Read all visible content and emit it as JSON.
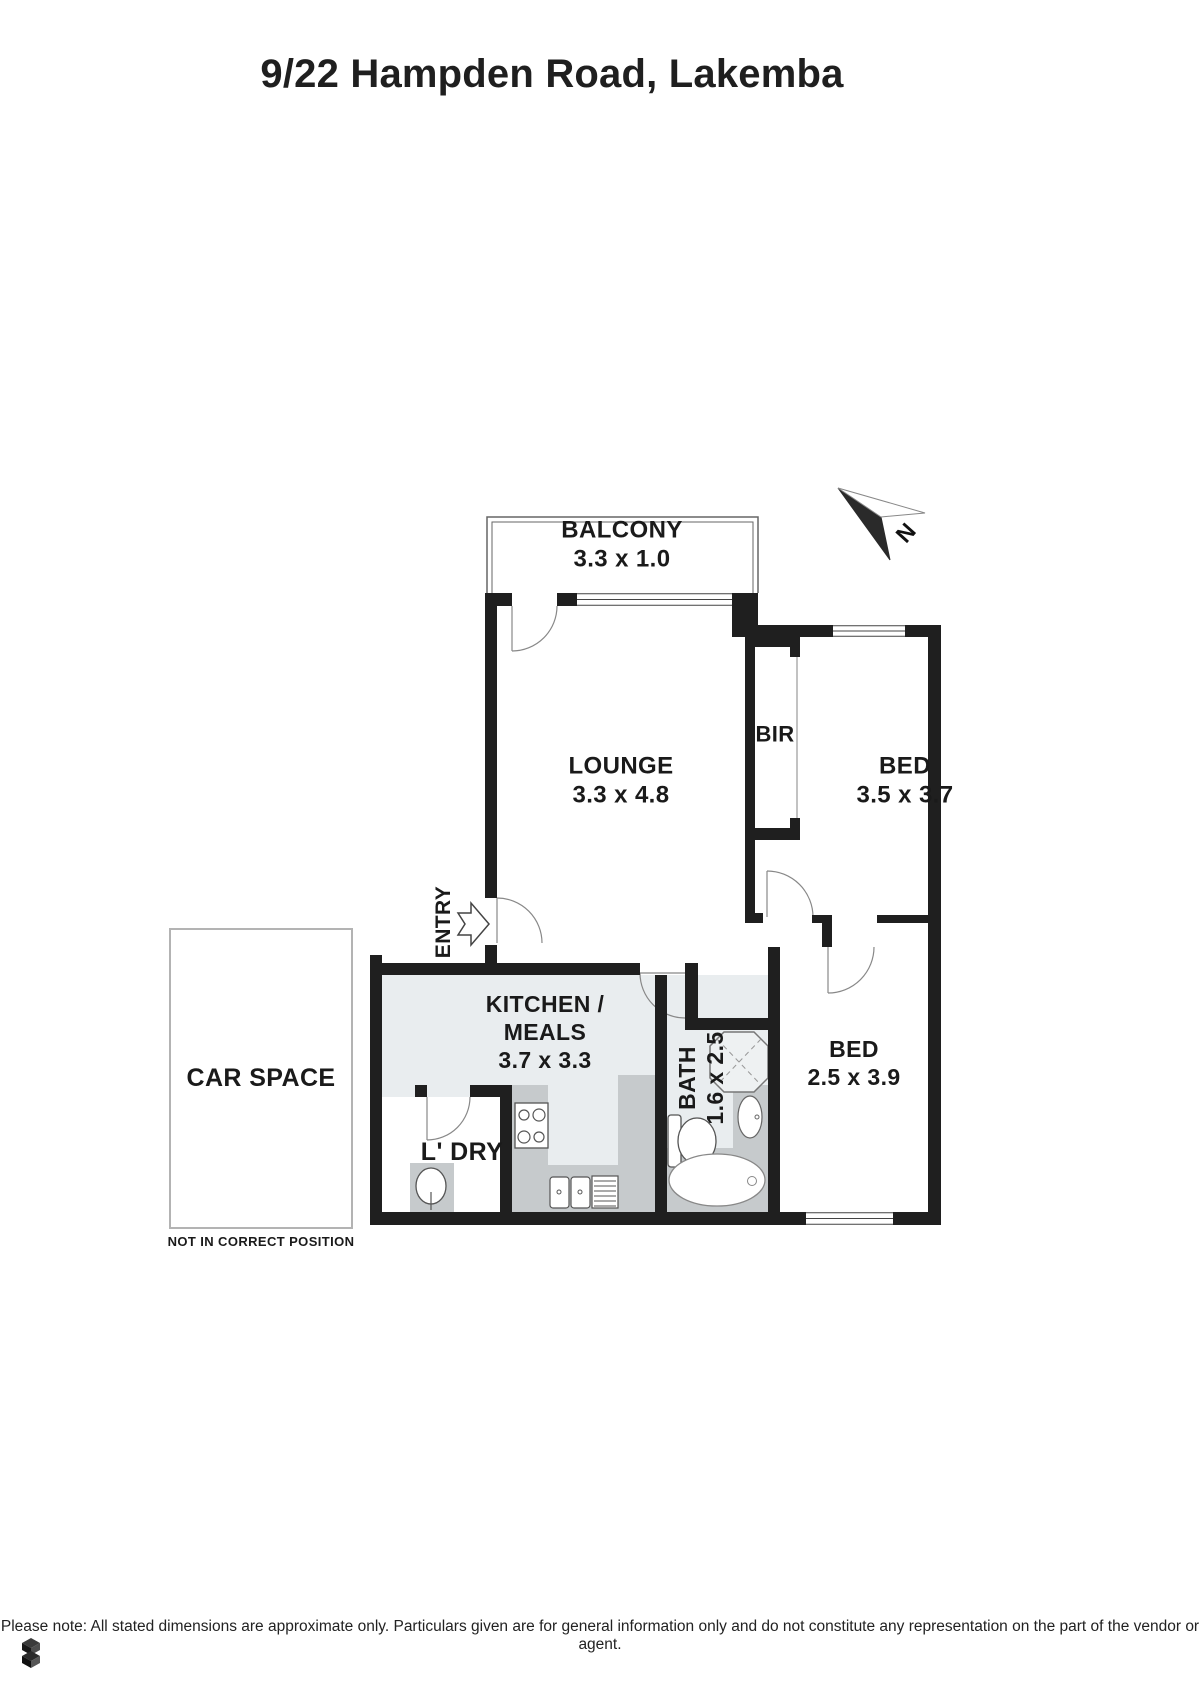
{
  "page": {
    "title": "9/22 Hampden Road, Lakemba",
    "footer": "Please note: All stated dimensions are approximate only. Particulars given are for general information only and do not constitute any representation on the part of the vendor or agent."
  },
  "compass": {
    "letter": "N",
    "x": 906,
    "y": 533,
    "fs": 23
  },
  "labels": [
    {
      "name": "balcony-label",
      "x": 622,
      "y": 545,
      "fs": 24,
      "lines": [
        "BALCONY",
        "3.3 x 1.0"
      ]
    },
    {
      "name": "lounge-label",
      "x": 621,
      "y": 781,
      "fs": 24,
      "lines": [
        "LOUNGE",
        "3.3 x 4.8"
      ]
    },
    {
      "name": "bed1-label",
      "x": 905,
      "y": 781,
      "fs": 24,
      "lines": [
        "BED",
        "3.5 x 3.7"
      ]
    },
    {
      "name": "bir-label",
      "x": 775,
      "y": 735,
      "fs": 22,
      "lines": [
        "BIR"
      ]
    },
    {
      "name": "kitchen-label",
      "x": 545,
      "y": 1032,
      "fs": 23,
      "lines": [
        "KITCHEN /",
        "MEALS",
        "3.7 x 3.3"
      ]
    },
    {
      "name": "bath-label",
      "x": 701,
      "y": 1078,
      "fs": 23,
      "rot": true,
      "lines": [
        "BATH",
        "1.6 x 2.5"
      ]
    },
    {
      "name": "bed2-label",
      "x": 854,
      "y": 1063,
      "fs": 23,
      "lines": [
        "BED",
        "2.5 x 3.9"
      ]
    },
    {
      "name": "entry-label",
      "x": 444,
      "y": 922,
      "fs": 21,
      "rot": true,
      "lines": [
        "ENTRY"
      ]
    },
    {
      "name": "laundry-label",
      "x": 462,
      "y": 1152,
      "fs": 25,
      "lines": [
        "L' DRY"
      ]
    },
    {
      "name": "carspace-label",
      "x": 261,
      "y": 1078,
      "fs": 25,
      "lines": [
        "CAR SPACE"
      ]
    },
    {
      "name": "carspace-note",
      "x": 261,
      "y": 1242,
      "fs": 13,
      "lines": [
        "NOT IN CORRECT POSITION"
      ]
    }
  ],
  "plan": {
    "colors": {
      "wall": "#1f1f1f",
      "tint": "#e9edef",
      "counter": "#c6cacc",
      "thin": "#888",
      "fix": "#555"
    },
    "walls": [
      [
        485,
        593,
        27,
        13
      ],
      [
        557,
        593,
        20,
        13
      ],
      [
        732,
        593,
        26,
        44
      ],
      [
        758,
        625,
        75,
        12
      ],
      [
        905,
        625,
        36,
        12
      ],
      [
        928,
        625,
        13,
        600
      ],
      [
        485,
        593,
        12,
        305
      ],
      [
        485,
        945,
        12,
        30
      ],
      [
        745,
        606,
        10,
        307
      ],
      [
        745,
        913,
        18,
        10
      ],
      [
        812,
        915,
        10,
        8
      ],
      [
        822,
        915,
        10,
        32
      ],
      [
        877,
        915,
        64,
        8
      ],
      [
        370,
        955,
        12,
        270
      ],
      [
        382,
        963,
        258,
        12
      ],
      [
        685,
        963,
        13,
        67
      ],
      [
        692,
        1018,
        88,
        12
      ],
      [
        655,
        975,
        12,
        237
      ],
      [
        768,
        947,
        12,
        265
      ],
      [
        370,
        1212,
        436,
        13
      ],
      [
        893,
        1212,
        48,
        13
      ],
      [
        415,
        1085,
        12,
        12
      ],
      [
        470,
        1085,
        42,
        12
      ],
      [
        500,
        1085,
        12,
        127
      ],
      [
        755,
        635,
        45,
        12
      ],
      [
        790,
        647,
        10,
        10
      ],
      [
        755,
        828,
        45,
        12
      ],
      [
        790,
        818,
        10,
        10
      ]
    ],
    "windows": [
      {
        "x": 577,
        "y": 593,
        "w": 155,
        "h": 13
      },
      {
        "x": 833,
        "y": 625,
        "w": 72,
        "h": 12
      },
      {
        "x": 806,
        "y": 1212,
        "w": 87,
        "h": 13
      }
    ],
    "shapes": [
      {
        "t": "rect",
        "n": "kitchen-floor",
        "x": 382,
        "y": 975,
        "w": 273,
        "h": 237,
        "f": "#e9edef"
      },
      {
        "t": "rect",
        "n": "bath-floor",
        "x": 667,
        "y": 975,
        "w": 101,
        "h": 237,
        "f": "#e9edef"
      },
      {
        "t": "rect",
        "n": "laundry-floor",
        "x": 382,
        "y": 1097,
        "w": 118,
        "h": 115,
        "f": "#ffffff"
      },
      {
        "t": "rect",
        "n": "kitchen-counter-left",
        "x": 512,
        "y": 1085,
        "w": 36,
        "h": 127,
        "f": "#c6cacc"
      },
      {
        "t": "rect",
        "n": "kitchen-counter-bottom",
        "x": 512,
        "y": 1165,
        "w": 143,
        "h": 47,
        "f": "#c6cacc"
      },
      {
        "t": "rect",
        "n": "kitchen-counter-right",
        "x": 618,
        "y": 1075,
        "w": 37,
        "h": 137,
        "f": "#c6cacc"
      },
      {
        "t": "rect",
        "n": "laundry-tub-bench",
        "x": 410,
        "y": 1163,
        "w": 44,
        "h": 49,
        "f": "#c6cacc"
      },
      {
        "t": "rect",
        "n": "vanity-bench",
        "x": 733,
        "y": 1085,
        "w": 35,
        "h": 65,
        "f": "#c6cacc"
      },
      {
        "t": "rect",
        "n": "bathtub-surround",
        "x": 667,
        "y": 1148,
        "w": 101,
        "h": 64,
        "f": "#c6cacc"
      },
      {
        "t": "path",
        "n": "balcony-outline-outer",
        "d": "M487,593 L487,517 L758,517 L758,593",
        "s": "#666",
        "sw": 1.5,
        "f": "none"
      },
      {
        "t": "path",
        "n": "balcony-outline-inner",
        "d": "M492,593 L492,522 L753,522 L753,593",
        "s": "#666",
        "sw": 1,
        "f": "none"
      },
      {
        "t": "rect",
        "n": "carspace-box",
        "x": 170,
        "y": 929,
        "w": 182,
        "h": 299,
        "f": "none",
        "s": "#b3b3b3",
        "sw": 2
      },
      {
        "t": "line",
        "n": "bir-front-line",
        "x1": 797,
        "y1": 647,
        "x2": 797,
        "y2": 828,
        "s": "#999",
        "sw": 1.2
      },
      {
        "t": "line",
        "n": "balcony-door-leaf",
        "x1": 512,
        "y1": 606,
        "x2": 512,
        "y2": 651,
        "s": "#888",
        "sw": 1.2
      },
      {
        "t": "path",
        "n": "balcony-door-arc",
        "d": "M557,606 A45,45 0 0 1 512,651",
        "s": "#888",
        "sw": 1.2,
        "f": "none"
      },
      {
        "t": "line",
        "n": "entry-door-leaf",
        "x1": 497,
        "y1": 898,
        "x2": 497,
        "y2": 943,
        "s": "#888",
        "sw": 1.2
      },
      {
        "t": "path",
        "n": "entry-door-arc",
        "d": "M497,898 A45,45 0 0 1 542,943",
        "s": "#888",
        "sw": 1.2,
        "f": "none"
      },
      {
        "t": "line",
        "n": "bath-door-leaf",
        "x1": 685,
        "y1": 973,
        "x2": 640,
        "y2": 973,
        "s": "#888",
        "sw": 1.2
      },
      {
        "t": "path",
        "n": "bath-door-arc",
        "d": "M640,973 A45,45 0 0 0 685,1018",
        "s": "#888",
        "sw": 1.2,
        "f": "none"
      },
      {
        "t": "line",
        "n": "laundry-door-leaf",
        "x1": 427,
        "y1": 1097,
        "x2": 427,
        "y2": 1140,
        "s": "#888",
        "sw": 1.2
      },
      {
        "t": "path",
        "n": "laundry-door-arc",
        "d": "M470,1097 A43,43 0 0 1 427,1140",
        "s": "#888",
        "sw": 1.2,
        "f": "none"
      },
      {
        "t": "line",
        "n": "bed1-door-leaf",
        "x1": 767,
        "y1": 871,
        "x2": 767,
        "y2": 917,
        "s": "#888",
        "sw": 1.2
      },
      {
        "t": "path",
        "n": "bed1-door-arc",
        "d": "M767,871 A46,46 0 0 1 813,917",
        "s": "#888",
        "sw": 1.2,
        "f": "none"
      },
      {
        "t": "line",
        "n": "bed2-door-leaf",
        "x1": 828,
        "y1": 947,
        "x2": 828,
        "y2": 993,
        "s": "#888",
        "sw": 1.2
      },
      {
        "t": "path",
        "n": "bed2-door-arc",
        "d": "M874,947 A46,46 0 0 1 828,993",
        "s": "#888",
        "sw": 1.2,
        "f": "none"
      },
      {
        "t": "polygon",
        "n": "shower",
        "pts": "724,1032 754,1032 768,1046 768,1078 754,1092 724,1092 710,1078 710,1046",
        "f": "#eef1f2",
        "s": "#777",
        "sw": 1.5
      },
      {
        "t": "line",
        "n": "shower-diag-1",
        "x1": 717,
        "y1": 1039,
        "x2": 761,
        "y2": 1085,
        "s": "#999",
        "sw": 1,
        "dash": "5,4"
      },
      {
        "t": "line",
        "n": "shower-diag-2",
        "x1": 761,
        "y1": 1039,
        "x2": 717,
        "y2": 1085,
        "s": "#999",
        "sw": 1,
        "dash": "5,4"
      },
      {
        "t": "rect",
        "n": "stove",
        "x": 515,
        "y": 1103,
        "w": 33,
        "h": 45,
        "f": "#fff",
        "s": "#555",
        "sw": 1.3
      },
      {
        "t": "circle",
        "n": "stove-burner",
        "cx": 524,
        "cy": 1115,
        "r": 5,
        "f": "#fff",
        "s": "#555",
        "sw": 1.2
      },
      {
        "t": "circle",
        "n": "stove-burner",
        "cx": 539,
        "cy": 1115,
        "r": 6,
        "f": "#fff",
        "s": "#555",
        "sw": 1.2
      },
      {
        "t": "circle",
        "n": "stove-burner",
        "cx": 524,
        "cy": 1137,
        "r": 6,
        "f": "#fff",
        "s": "#555",
        "sw": 1.2
      },
      {
        "t": "circle",
        "n": "stove-burner",
        "cx": 539,
        "cy": 1137,
        "r": 5,
        "f": "#fff",
        "s": "#555",
        "sw": 1.2
      },
      {
        "t": "rect",
        "n": "sink-basin",
        "x": 550,
        "y": 1177,
        "w": 19,
        "h": 31,
        "rx": 3,
        "f": "#fff",
        "s": "#555",
        "sw": 1.2
      },
      {
        "t": "circle",
        "n": "sink-drain",
        "cx": 559,
        "cy": 1192,
        "r": 2,
        "f": "#fff",
        "s": "#555",
        "sw": 1
      },
      {
        "t": "rect",
        "n": "sink-basin",
        "x": 571,
        "y": 1177,
        "w": 19,
        "h": 31,
        "rx": 3,
        "f": "#fff",
        "s": "#555",
        "sw": 1.2
      },
      {
        "t": "circle",
        "n": "sink-drain",
        "cx": 580,
        "cy": 1192,
        "r": 2,
        "f": "#fff",
        "s": "#555",
        "sw": 1
      },
      {
        "t": "rect",
        "n": "sink-drainer",
        "x": 592,
        "y": 1176,
        "w": 26,
        "h": 32,
        "f": "#fff",
        "s": "#555",
        "sw": 1.2
      },
      {
        "t": "line",
        "n": "drainer-line",
        "x1": 594,
        "y1": 1181,
        "x2": 616,
        "y2": 1181,
        "s": "#555",
        "sw": 1
      },
      {
        "t": "line",
        "n": "drainer-line",
        "x1": 594,
        "y1": 1186,
        "x2": 616,
        "y2": 1186,
        "s": "#555",
        "sw": 1
      },
      {
        "t": "line",
        "n": "drainer-line",
        "x1": 594,
        "y1": 1191,
        "x2": 616,
        "y2": 1191,
        "s": "#555",
        "sw": 1
      },
      {
        "t": "line",
        "n": "drainer-line",
        "x1": 594,
        "y1": 1196,
        "x2": 616,
        "y2": 1196,
        "s": "#555",
        "sw": 1
      },
      {
        "t": "line",
        "n": "drainer-line",
        "x1": 594,
        "y1": 1201,
        "x2": 616,
        "y2": 1201,
        "s": "#555",
        "sw": 1
      },
      {
        "t": "line",
        "n": "drainer-line",
        "x1": 594,
        "y1": 1206,
        "x2": 616,
        "y2": 1206,
        "s": "#555",
        "sw": 1
      },
      {
        "t": "ellipse",
        "n": "laundry-tub",
        "cx": 431,
        "cy": 1186,
        "rx": 15,
        "ry": 18,
        "f": "#fff",
        "s": "#555",
        "sw": 1.3
      },
      {
        "t": "line",
        "n": "laundry-tap",
        "x1": 431,
        "y1": 1192,
        "x2": 431,
        "y2": 1210,
        "s": "#555",
        "sw": 1.2
      },
      {
        "t": "rect",
        "n": "toilet-tank",
        "x": 668,
        "y": 1115,
        "w": 13,
        "h": 52,
        "rx": 3,
        "f": "#fff",
        "s": "#555",
        "sw": 1.3
      },
      {
        "t": "ellipse",
        "n": "toilet-bowl",
        "cx": 697,
        "cy": 1141,
        "rx": 19,
        "ry": 23,
        "f": "#fff",
        "s": "#555",
        "sw": 1.3
      },
      {
        "t": "ellipse",
        "n": "vanity-basin",
        "cx": 750,
        "cy": 1117,
        "rx": 12,
        "ry": 21,
        "f": "#fff",
        "s": "#666",
        "sw": 1.2
      },
      {
        "t": "circle",
        "n": "vanity-tap",
        "cx": 757,
        "cy": 1117,
        "r": 2,
        "f": "#fff",
        "s": "#666",
        "sw": 1
      },
      {
        "t": "ellipse",
        "n": "bathtub",
        "cx": 717,
        "cy": 1180,
        "rx": 48,
        "ry": 26,
        "f": "#fff",
        "s": "#888",
        "sw": 1.3
      },
      {
        "t": "circle",
        "n": "bathtub-drain",
        "cx": 752,
        "cy": 1181,
        "r": 4.5,
        "f": "#fff",
        "s": "#888",
        "sw": 1
      },
      {
        "t": "polygon",
        "n": "north-arrow-dark",
        "pts": "838,488 890,560 881,517",
        "f": "#2a2a2a",
        "s": "#2a2a2a",
        "sw": 1
      },
      {
        "t": "polygon",
        "n": "north-arrow-light",
        "pts": "838,488 925,513 881,517",
        "f": "#ffffff",
        "s": "#888",
        "sw": 1
      },
      {
        "t": "polygon",
        "n": "entry-arrow",
        "pts": "458,913 471,913 471,903 489,924 471,945 471,935 458,935 465,924",
        "f": "#ffffff",
        "s": "#444",
        "sw": 1.5
      }
    ]
  }
}
